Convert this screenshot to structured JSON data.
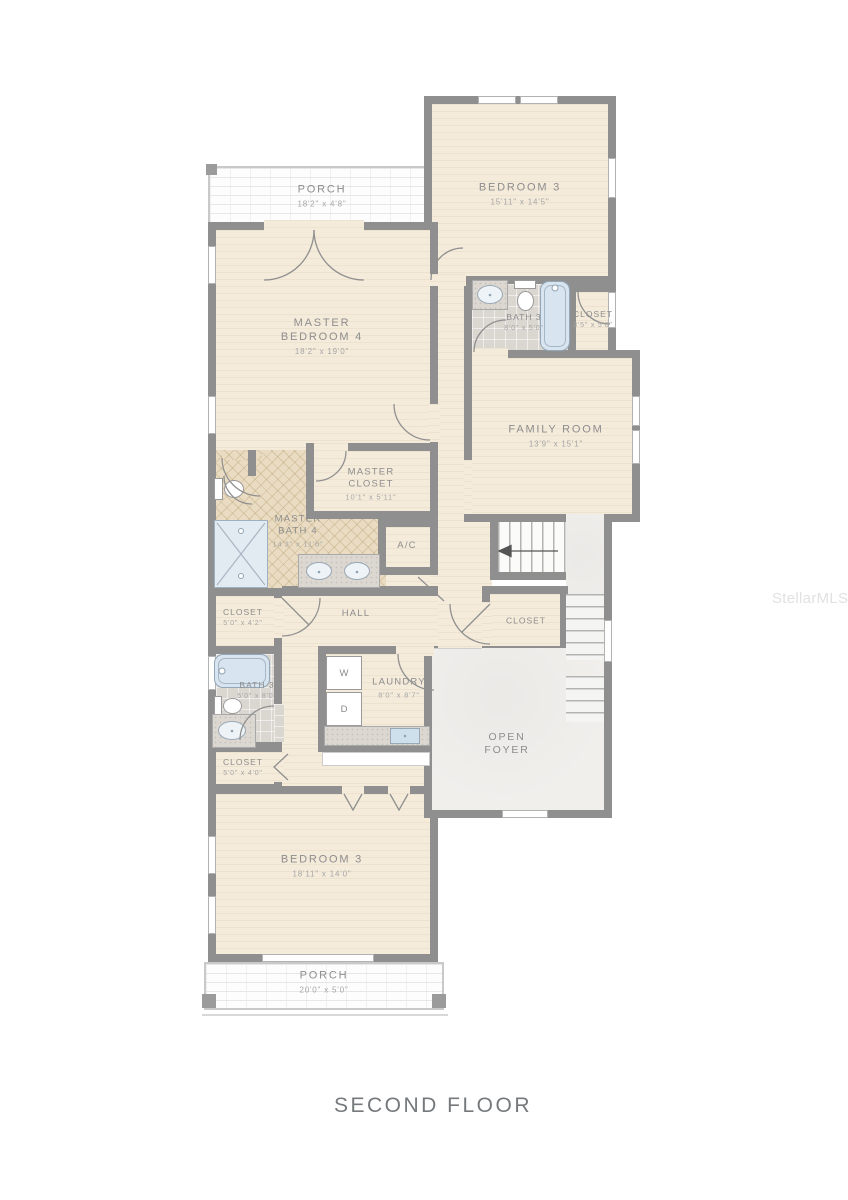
{
  "title": "SECOND FLOOR",
  "watermark": "StellarMLS",
  "colors": {
    "wall": "#8f8f8f",
    "floor": "#f4ebdb",
    "tile": "#dad6d0",
    "herringbone": "#e9dcc2",
    "foyer": "#f0efec",
    "fixture_blue": "#d8e4ef",
    "label_text": "#8d8d8d"
  },
  "appliances": {
    "washer": "W",
    "dryer": "D"
  },
  "rooms": {
    "porch_top": {
      "name": "PORCH",
      "dims": "18'2\" x 4'8\""
    },
    "bedroom3_top": {
      "name": "BEDROOM 3",
      "dims": "15'11\" x 14'5\""
    },
    "master_bedroom": {
      "name": "MASTER BEDROOM 4",
      "dims": "18'2\" x 19'0\""
    },
    "bath3_top": {
      "name": "BATH 3",
      "dims": "8'0\" x 5'0\""
    },
    "closet_top": {
      "name": "CLOSET",
      "dims": "3'5\" x 5'0\""
    },
    "family_room": {
      "name": "FAMILY ROOM",
      "dims": "13'9\" x 15'1\""
    },
    "master_closet": {
      "name": "MASTER CLOSET",
      "dims": "10'1\" x 5'11\""
    },
    "master_bath": {
      "name": "MASTER BATH 4",
      "dims": "14'3\" x 11'6\""
    },
    "ac": {
      "name": "A/C"
    },
    "hall": {
      "name": "HALL"
    },
    "closet_hall": {
      "name": "CLOSET",
      "dims": "5'0\" x 4'2\""
    },
    "bath3_lower": {
      "name": "BATH 3",
      "dims": "5'0\" x 8'0\""
    },
    "laundry": {
      "name": "LAUNDRY",
      "dims": "8'0\" x 8'7\""
    },
    "closet_stairs": {
      "name": "CLOSET"
    },
    "closet_lower": {
      "name": "CLOSET",
      "dims": "5'0\" x 4'0\""
    },
    "open_foyer": {
      "name": "OPEN FOYER"
    },
    "bedroom3_bottom": {
      "name": "BEDROOM 3",
      "dims": "18'11\" x 14'0\""
    },
    "porch_bottom": {
      "name": "PORCH",
      "dims": "20'0\" x 5'0\""
    }
  }
}
